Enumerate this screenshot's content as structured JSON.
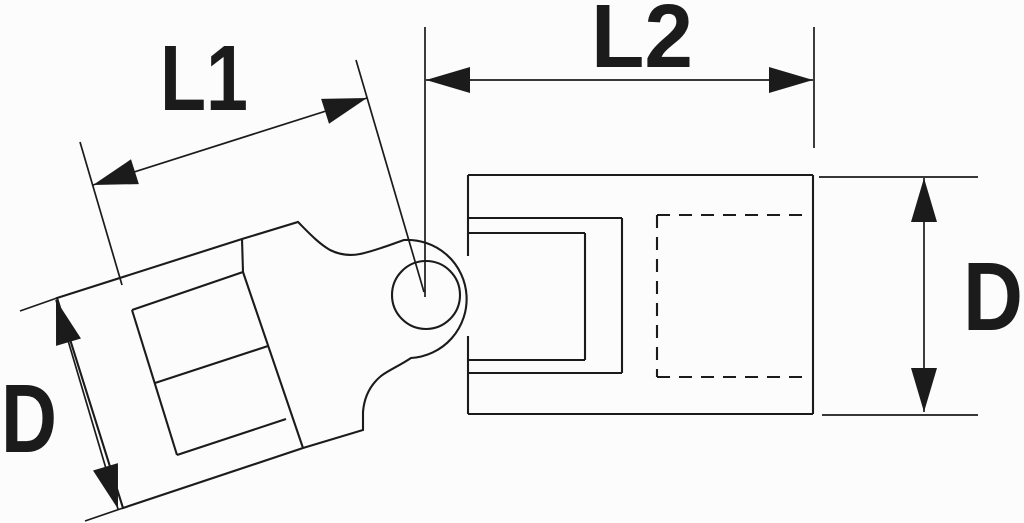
{
  "figure": {
    "kind": "technical-line-drawing",
    "subject": "universal joint wobble socket side view with dimension callouts",
    "ink_color": "#1b1b1b",
    "background_color": "#fcfcfc",
    "width": 1024,
    "height": 523
  },
  "labels": [
    {
      "id": "dim-label-l1",
      "text": "L1",
      "x": 160,
      "y": 110,
      "font_size": 93,
      "text_length": 88
    },
    {
      "id": "dim-label-l2",
      "text": "L2",
      "x": 591,
      "y": 67,
      "font_size": 90,
      "text_length": 102
    },
    {
      "id": "dim-label-d-right",
      "text": "D",
      "x": 963,
      "y": 330,
      "font_size": 97,
      "text_length": 60
    },
    {
      "id": "dim-label-d-left",
      "text": "D",
      "x": 1,
      "y": 452,
      "font_size": 97,
      "text_length": 56
    }
  ],
  "geometry": {
    "left_part": {
      "outline": "M 57,298 L 242,239 L 298,222 C 308,232 318,243 330,250 C 340,255 350,256 360,254 C 375,251 392,244 404,240 A 58 58 0 1 1 411,358 C 399,366 389,370 381,376 C 369,386 364,399 363,412 L 363,430 L 303,448 L 123,508 Z",
      "inner_lines": [
        [
          242,
          239,
          243,
          272
        ],
        [
          243,
          272,
          303,
          448
        ],
        [
          132,
          310,
          243,
          272
        ],
        [
          155,
          383,
          268,
          346
        ],
        [
          177,
          455,
          286,
          419
        ],
        [
          132,
          310,
          177,
          455
        ]
      ]
    },
    "pin": {
      "cx": 426,
      "cy": 295,
      "r": 34
    },
    "right_body": {
      "solid_lines": [
        [
          468,
          175,
          813,
          175
        ],
        [
          813,
          175,
          813,
          414
        ],
        [
          468,
          414,
          813,
          414
        ],
        [
          468,
          175,
          468,
          256
        ],
        [
          468,
          336,
          468,
          414
        ],
        [
          468,
          218,
          622,
          218
        ],
        [
          622,
          218,
          622,
          373
        ],
        [
          468,
          373,
          622,
          373
        ],
        [
          468,
          233,
          585,
          233
        ],
        [
          585,
          233,
          585,
          360
        ],
        [
          468,
          360,
          585,
          360
        ]
      ],
      "hidden_dashed_lines": [
        [
          657,
          215,
          810,
          215
        ],
        [
          657,
          377,
          810,
          377
        ],
        [
          657,
          215,
          657,
          377
        ]
      ]
    },
    "dimensions": {
      "dim_lines": [
        [
          93,
          185,
          367,
          98
        ],
        [
          426,
          80,
          813,
          80
        ],
        [
          924,
          178,
          924,
          412
        ],
        [
          56,
          300,
          118,
          509
        ]
      ],
      "extension_lines": [
        [
          80,
          142,
          122,
          285
        ],
        [
          356,
          60,
          424,
          292
        ],
        [
          425,
          27,
          425,
          297
        ],
        [
          814,
          27,
          814,
          148
        ],
        [
          819,
          177,
          978,
          177
        ],
        [
          822,
          415,
          978,
          415
        ],
        [
          20,
          311,
          57,
          298
        ],
        [
          85,
          521,
          123,
          508
        ]
      ],
      "arrows": [
        {
          "tip": [
            93,
            185
          ],
          "toward": [
            367,
            98
          ]
        },
        {
          "tip": [
            367,
            98
          ],
          "toward": [
            93,
            185
          ]
        },
        {
          "tip": [
            426,
            80
          ],
          "toward": [
            813,
            80
          ]
        },
        {
          "tip": [
            813,
            80
          ],
          "toward": [
            426,
            80
          ]
        },
        {
          "tip": [
            924,
            178
          ],
          "toward": [
            924,
            412
          ]
        },
        {
          "tip": [
            924,
            412
          ],
          "toward": [
            924,
            178
          ]
        },
        {
          "tip": [
            56,
            300
          ],
          "toward": [
            118,
            509
          ]
        },
        {
          "tip": [
            118,
            509
          ],
          "toward": [
            56,
            300
          ]
        }
      ],
      "arrow_length": 44,
      "arrow_half_width": 13
    }
  }
}
